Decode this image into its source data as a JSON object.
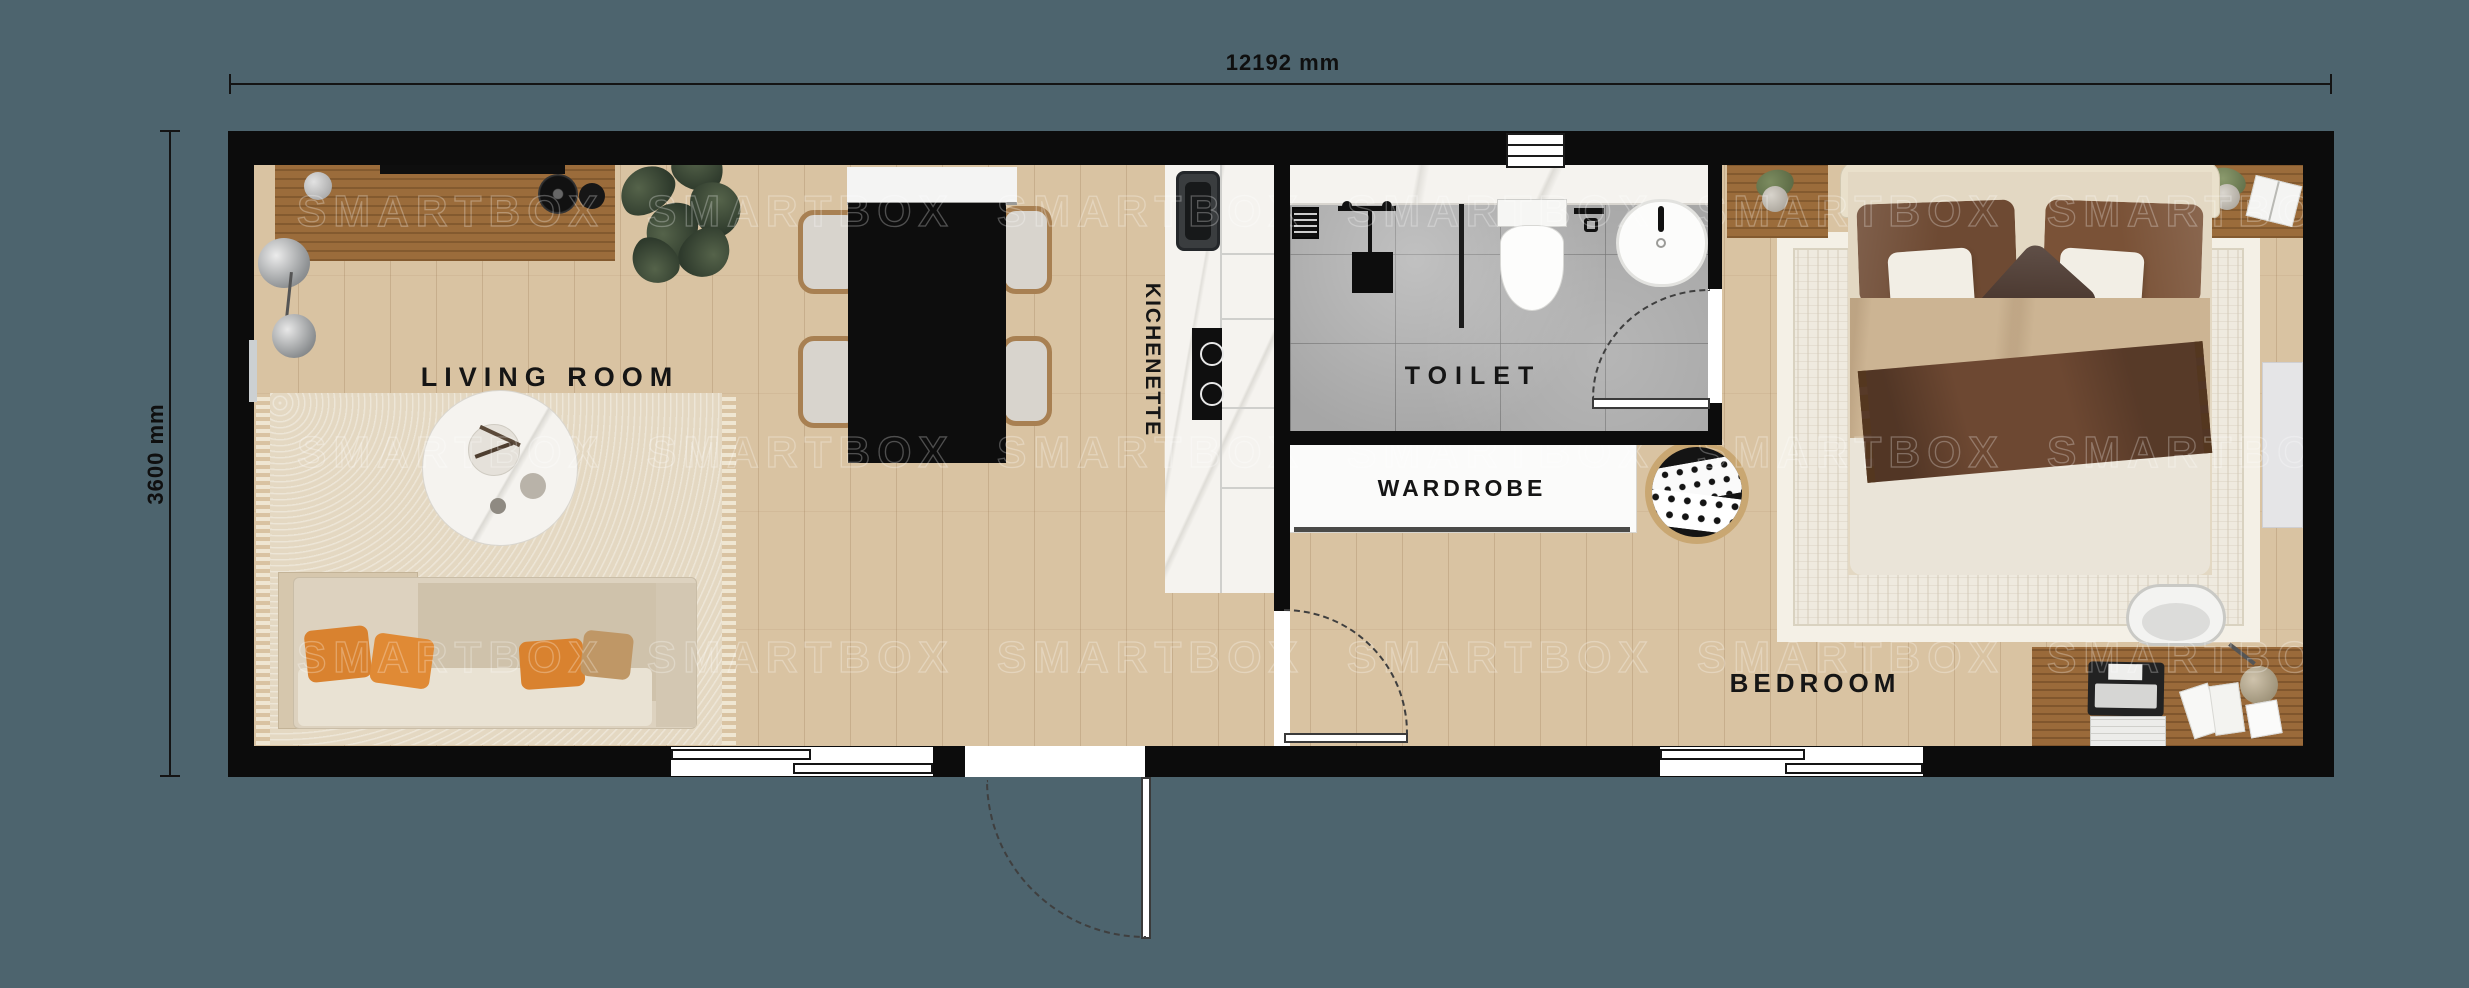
{
  "dimensions": {
    "width": "12192 mm",
    "height": "3600 mm"
  },
  "watermark": "SMARTBOX",
  "rooms": {
    "living_room": "LIVING ROOM",
    "kitchenette": "KICHENETTE",
    "toilet": "TOILET",
    "wardrobe": "WARDROBE",
    "bedroom": "BEDROOM"
  },
  "palette": {
    "background": "#4d646e",
    "wall": "#0c0c0c",
    "wood_floor": "#d9c3a2",
    "tile_floor": "#a6a6a6",
    "counter_marble": "#f5f3ef",
    "console_wood": "#9b6c3b",
    "accent_pillow_orange": "#d9822f",
    "bed_brown": "#6e4a33",
    "dining_table_black": "#0d0d0d"
  }
}
